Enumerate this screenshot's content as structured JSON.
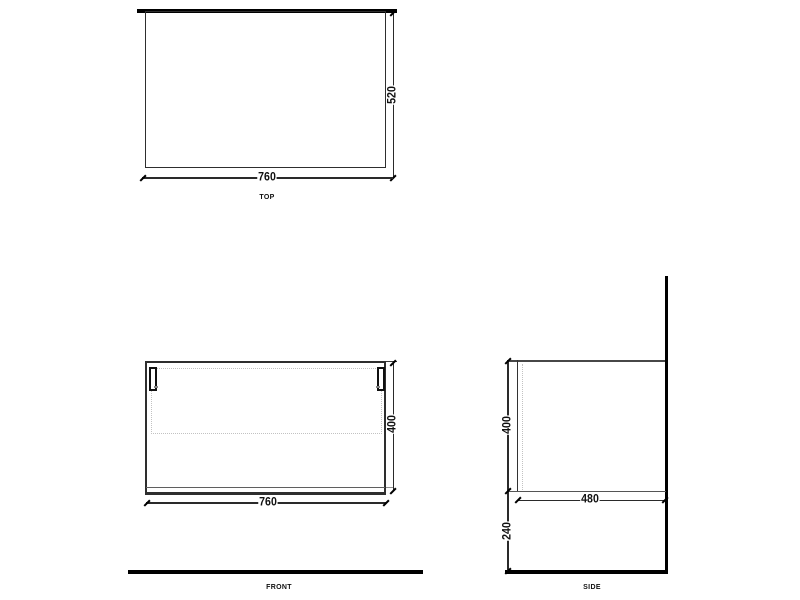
{
  "views": {
    "top": {
      "label": "TOP",
      "width_mm": "760",
      "depth_mm": "520"
    },
    "front": {
      "label": "FRONT",
      "width_mm": "760",
      "height_mm": "400"
    },
    "side": {
      "label": "SIDE",
      "height_mm": "400",
      "depth_mm": "480",
      "floor_clearance_mm": "240"
    }
  },
  "colors": {
    "line": "#2a2a2a",
    "thick_line": "#000000",
    "hidden_line": "#c2c2c2",
    "text": "#111111",
    "background": "#ffffff"
  }
}
